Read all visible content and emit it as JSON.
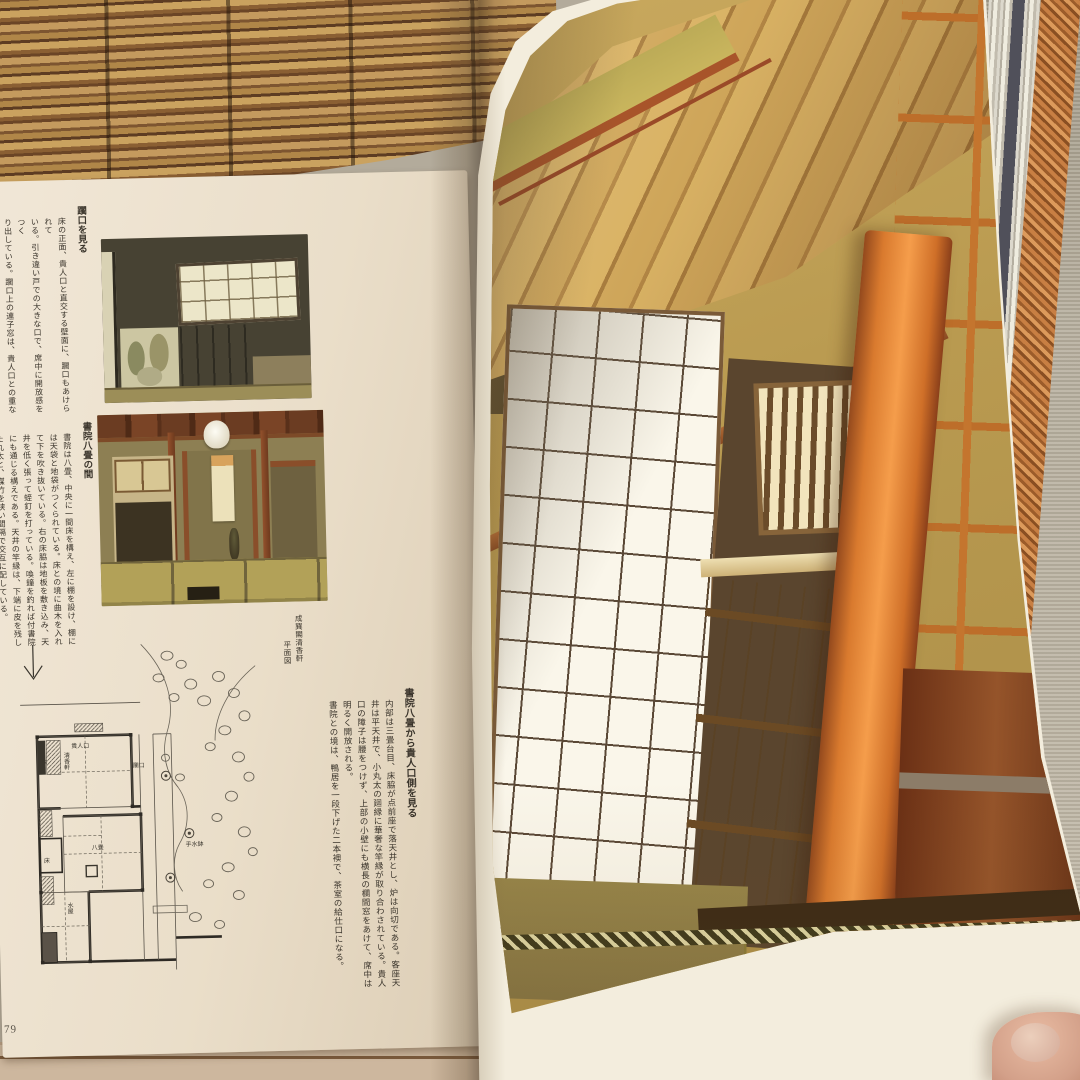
{
  "left_page": {
    "page_number": "79",
    "sections": [
      {
        "heading": "躙口を見る",
        "lines": [
          "床の正面、貴人口と直交する壁面に、躙口もあけられて",
          "いる。引き違い戸での大きな口で、席中に開放感をつく",
          "り出している。躙口上の連子窓は、貴人口との重なりを",
          "避けて、右のほうに寄せてあけられている。右に見える",
          "太鼓襖の口が、書院との室境である。"
        ]
      },
      {
        "heading": "書院八畳の間",
        "lines": [
          "書院は八畳、中央に一間床を構え、左に棚を設け、棚に",
          "は天袋と地袋がつくられている。床との境に曲木を入れ",
          "て下を吹き抜いている。右の床脇は地板を敷き込み、天",
          "井を低く張って蛭釘を打っている。喚鐘を釣れば付書院",
          "にも通じる構えである。天井の竿縁は、下端に皮を残し",
          "た丸太と、煤竹を狭い間隔で交互に配している。"
        ]
      }
    ],
    "plan_caption_lines": [
      "成巽閣清香軒",
      "平面図"
    ],
    "plan_labels": {
      "toko_top": "床",
      "seikoken": "清香軒",
      "kininguchi": "貴人口",
      "nijiriguchi": "躙口",
      "hachijo": "八畳",
      "toko_mid": "床",
      "mizuya": "水屋",
      "chozubachi": "手水鉢"
    }
  },
  "right_page_caption": {
    "heading": "書院八畳から貴人口側を見る",
    "lines": [
      "内部は三畳台目、床脇が点前座で落天井とし、炉は向切である。客座天",
      "井は平天井で、小丸太の廻縁に華奢な竿縁が取り合わされている。貴人",
      "口の障子は腰をつけず、上部の小壁にも横長の欄間窓をあけて、席中は",
      "明るく開放される。",
      "書院との境は、鴨居を一段下げた二本襖で、茶室の給仕口になる。"
    ]
  },
  "colors": {
    "paper": "#eadec9",
    "ink": "#3b352c",
    "tatami_gold": "#c2a54e",
    "pillar_orange": "#f59d4b",
    "shoji_white": "#faf6ea"
  }
}
